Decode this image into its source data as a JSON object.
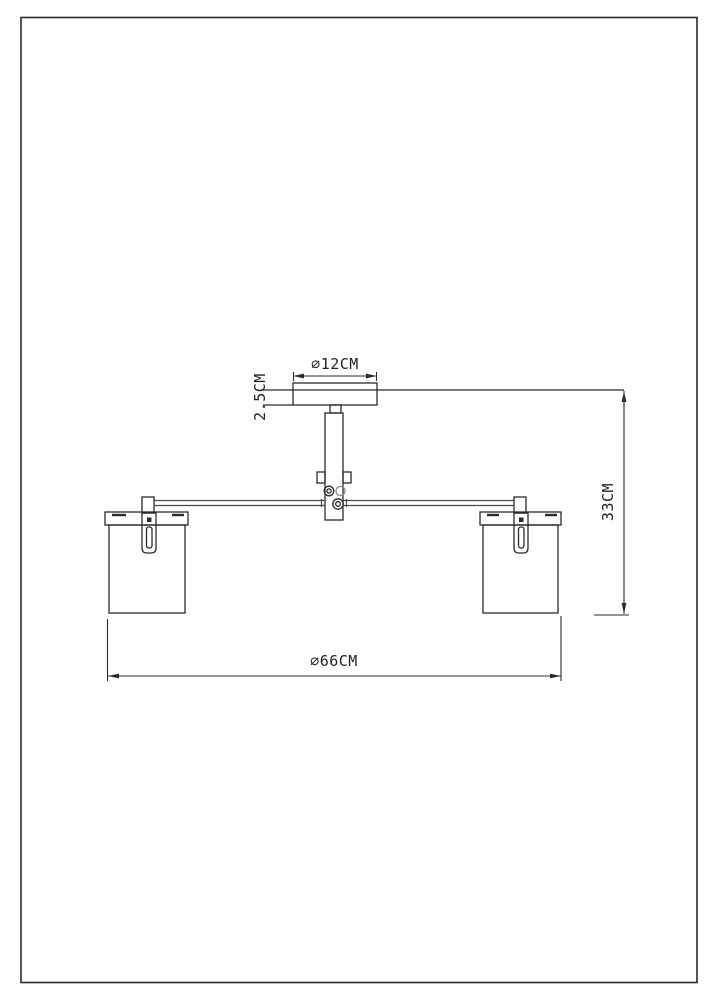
{
  "drawing": {
    "labels": {
      "canopy_diameter": "⌀12CM",
      "canopy_height": "2.5CM",
      "height": "33CM",
      "overall_diameter": "⌀66CM"
    },
    "colors": {
      "line": "#2b2b2b",
      "background": "#ffffff",
      "text": "#222222"
    }
  }
}
